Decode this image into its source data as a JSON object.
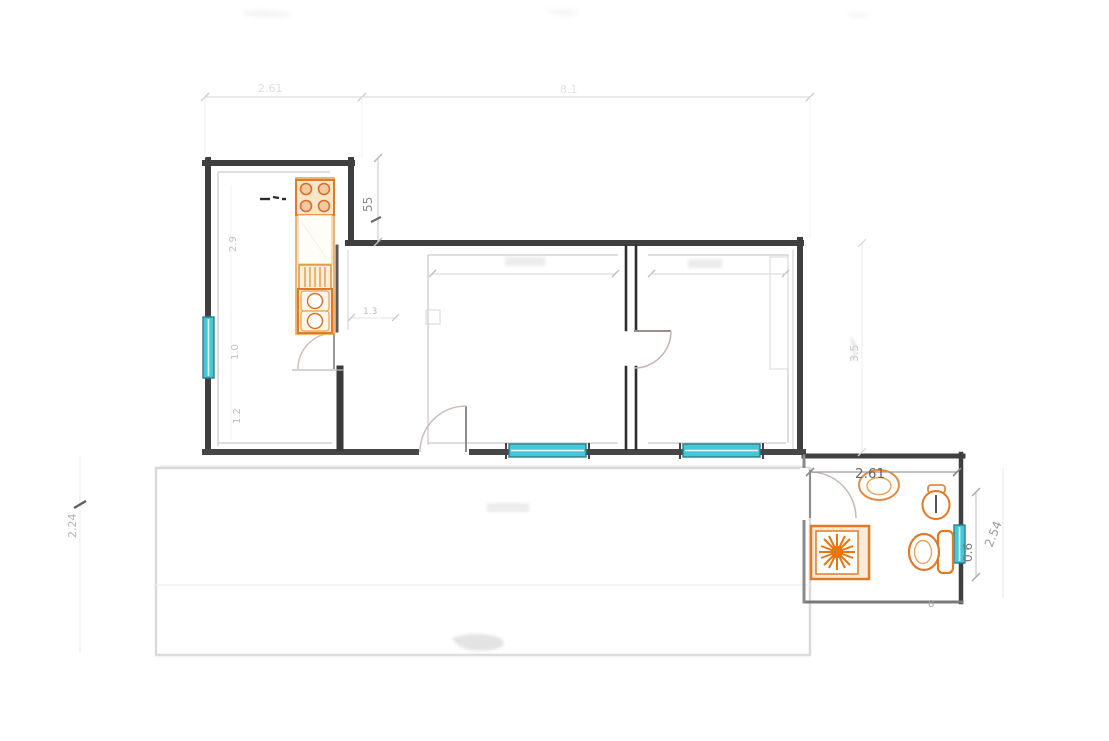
{
  "plan": {
    "dimension_labels": {
      "top_kitchen_width": "2.61",
      "top_main_width": "8.1",
      "kitchen_step_height": "55",
      "kitchen_interior_height": "2.9",
      "kitchen_window_height": "1.0",
      "kitchen_lower_section": "1.2",
      "kitchen_passage": "1.3",
      "terrace_depth": "2.24",
      "main_rooms_depth": "3.5",
      "bathroom_width": "2.61",
      "bathroom_window_width": "0.6",
      "bathroom_depth": "2.54",
      "bathroom_bottom_mark": "8"
    },
    "colors": {
      "wall": "#3f3f3f",
      "wall_light": "#6f6f6f",
      "fixture_orange": "#e07a28",
      "fixture_orange_strong": "#e8760e",
      "fixture_fill_light": "#fbeed8",
      "window_teal": "#45c8d6",
      "window_teal_dark": "#2f7d8a",
      "dim_text": "#9a9a9a",
      "dim_text_dark": "#6d6560",
      "faint_line": "#d9d9d9"
    },
    "fixture_icons": [
      "stove-icon",
      "dish-drainer-icon",
      "kitchen-sink-icon",
      "faucet-marking-icon",
      "shower-icon",
      "toilet-icon",
      "bidet-icon",
      "washbasin-icon",
      "window-glyph",
      "door-swing-glyph"
    ]
  }
}
